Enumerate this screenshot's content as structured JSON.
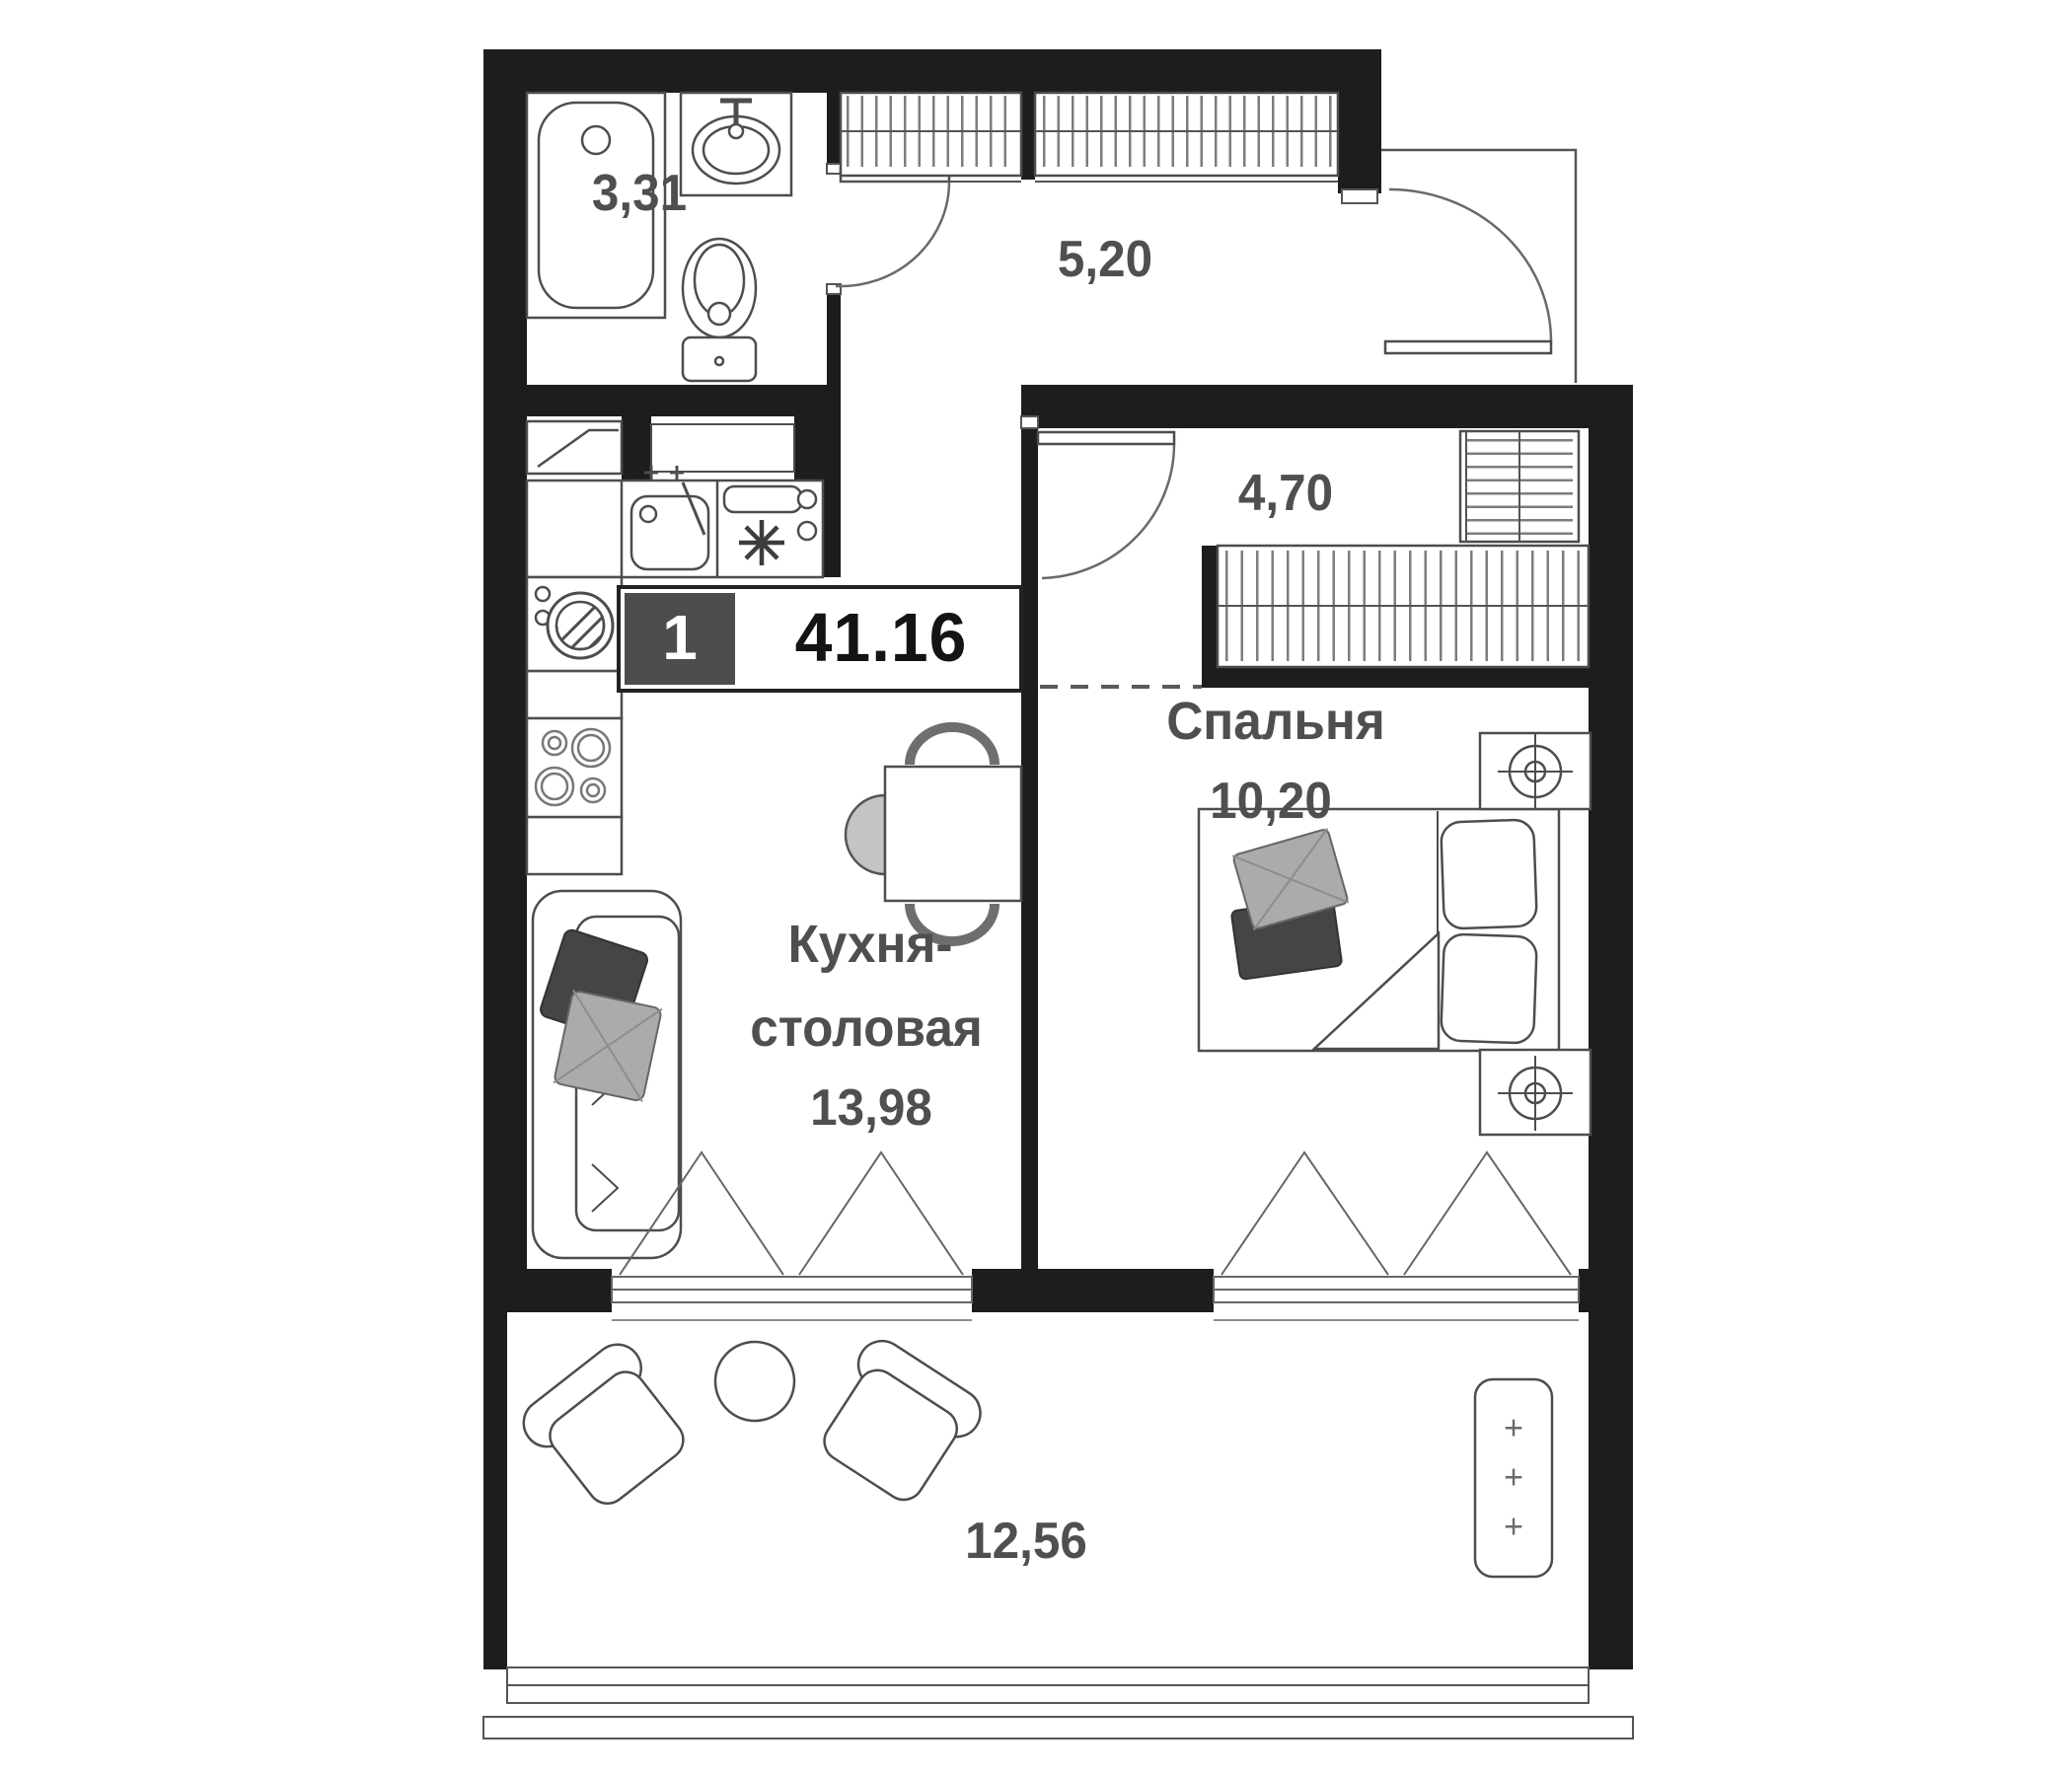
{
  "plan": {
    "badge": {
      "room_count": "1",
      "total_area": "41.16"
    },
    "rooms": {
      "bathroom": {
        "area": "3,31"
      },
      "hallway": {
        "area": "5,20"
      },
      "corridor": {
        "area": "4,70"
      },
      "bedroom": {
        "name": "Спальня",
        "area": "10,20"
      },
      "kitchen": {
        "name_line1": "Кухня-",
        "name_line2": "столовая",
        "area": "13,98"
      },
      "balcony": {
        "area": "12,56",
        "planter_mark": "+"
      }
    },
    "colors": {
      "wall": "#1d1d1d",
      "fixture_line": "#4d4d4d",
      "hatch": "#7d7d7d",
      "label": "#4f4f4f",
      "badge_box": "#4d4d4d",
      "pillow_dark": "#454545",
      "pillow_light": "#ababab",
      "chair_fill": "#c4c4c4"
    }
  }
}
